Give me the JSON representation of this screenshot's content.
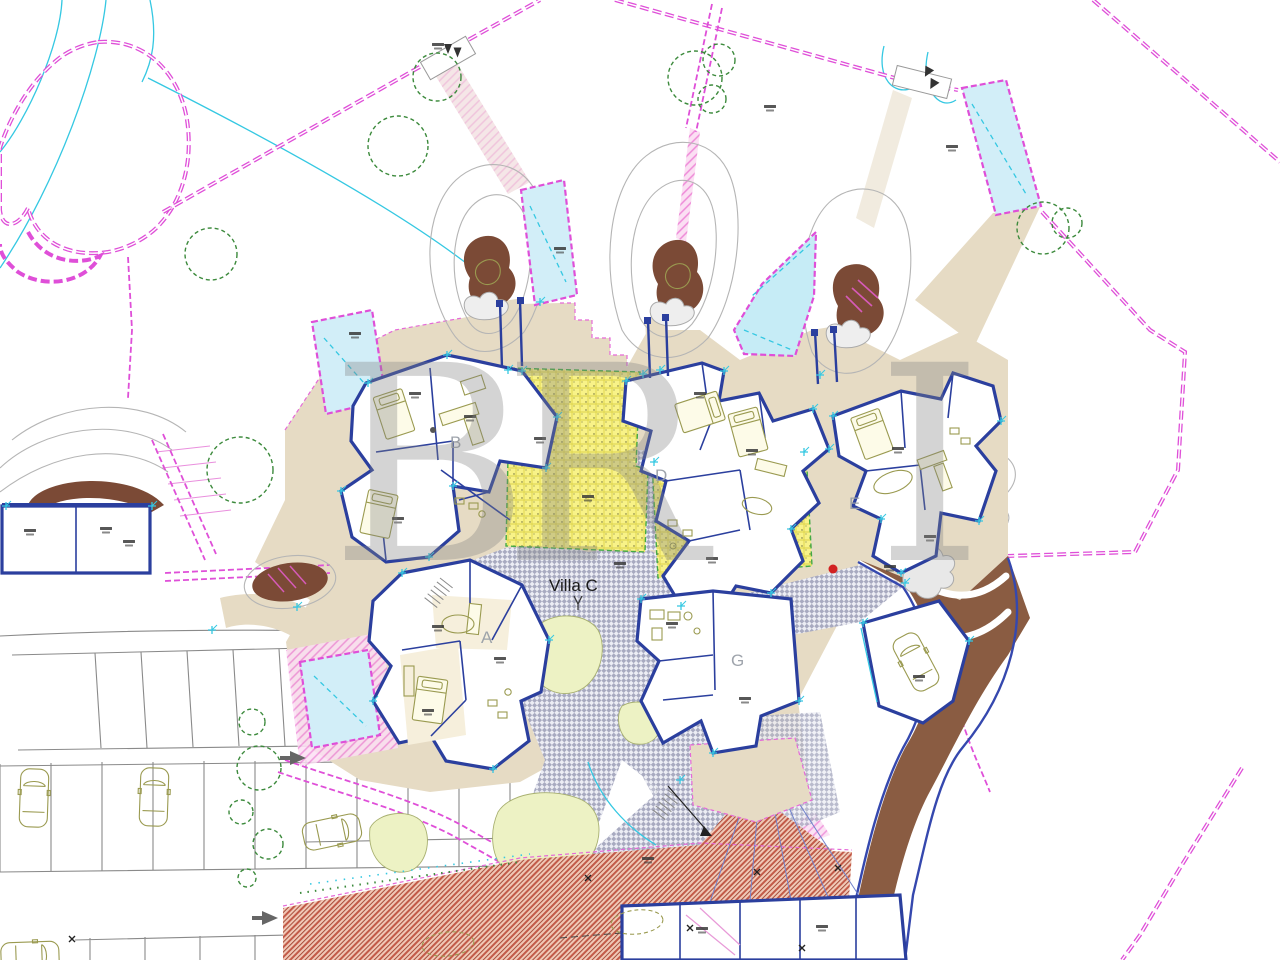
{
  "scene": {
    "type": "architectural-site-plan",
    "center_label": "Villa C",
    "unit_labels": {
      "a": "A",
      "b": "B",
      "d": "D",
      "e": "E",
      "g": "G"
    },
    "watermark_letters": [
      "B",
      "R",
      "I"
    ],
    "colors": {
      "boundary_magenta": "#df4fd8",
      "wall_blue": "#2b3f9e",
      "pool_fill": "#d2eef8",
      "pool_line": "#38c0dc",
      "terrace_tan": "#e6dbc4",
      "earth_brown": "#7b4a36",
      "band_brown": "#8a5c42",
      "yellow_zone": "#f8f288",
      "tree_green": "#3c8a3c",
      "furniture_olive": "#9a9a50",
      "plaza_gray": "#a8aac0",
      "hatch_red": "#c25a48",
      "lawn_green": "#edf2c4",
      "contour_cyan": "#7fd8e8",
      "watermark_gray": "#828282"
    }
  }
}
